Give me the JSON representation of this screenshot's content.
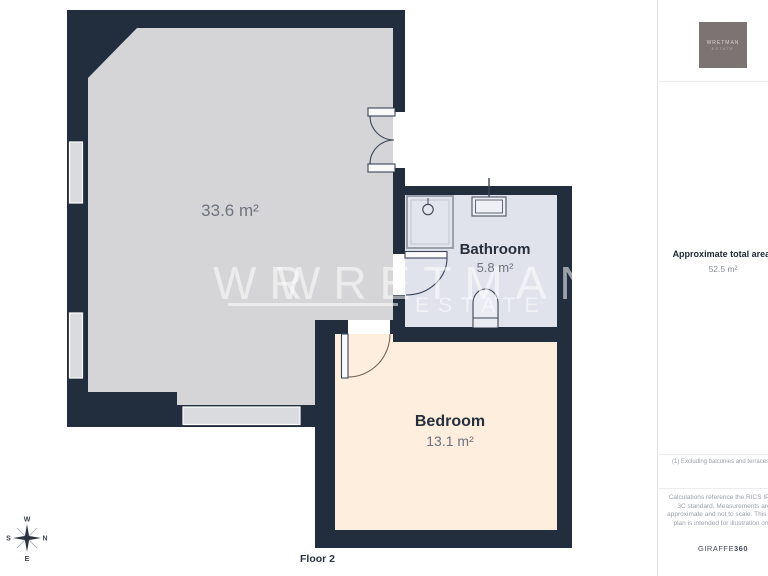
{
  "plan": {
    "rooms": [
      {
        "name": "",
        "area": "33.6 m²"
      },
      {
        "name": "Bathroom",
        "area": "5.8 m²"
      },
      {
        "name": "Bedroom",
        "area": "13.1 m²"
      }
    ],
    "floor_label": "Floor 2",
    "watermark": {
      "ghost": "WR",
      "line1": "WRETMAN",
      "line2": "ESTATE"
    },
    "compass": {
      "top": "W",
      "right": "N",
      "bottom": "E",
      "left": "S"
    }
  },
  "sidebar": {
    "logo": {
      "line1": "WRETMAN",
      "line2": "ESTATE"
    },
    "total_area_label": "Approximate total area",
    "total_area_superscript": "1",
    "total_area_value": "52.5 m²",
    "footnote": "(1) Excluding balconies and terraces",
    "disclaimer": "Calculations reference the RICS IPMS 3C standard. Measurements are approximate and not to scale. This floor plan is intended for illustration only.",
    "brand_name": "GIRAFFE",
    "brand_suffix": "360"
  },
  "colors": {
    "wall": "#222d3e",
    "main_floor": "#d5d5d7",
    "bathroom_floor": "#e0e3ec",
    "bedroom_floor": "#fdeedd",
    "window": "#dadbdf",
    "accent_text": "#28303e",
    "muted_text": "#6e7280"
  }
}
